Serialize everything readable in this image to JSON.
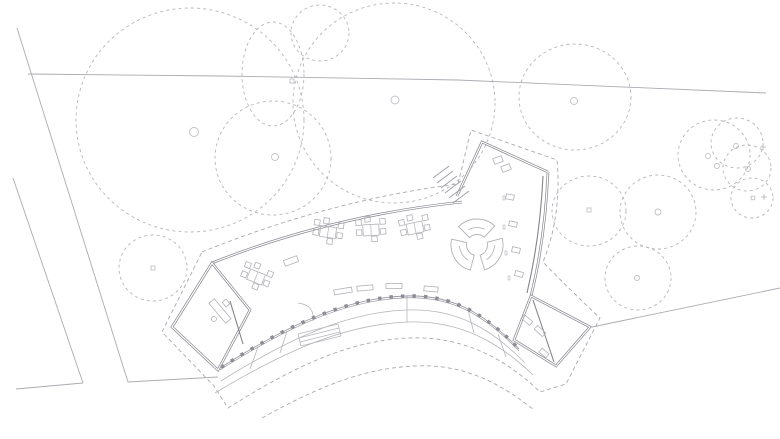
{
  "meta": {
    "title": "Architectural site plan — curved pavilion with terrace and trees",
    "canvas": {
      "w": 780,
      "h": 439,
      "bg": "#ffffff"
    }
  },
  "palette": {
    "tree": "#b6b6bc",
    "trunk": "#c2c2c8",
    "site_line": "#ababb1",
    "wall_dark": "#84848c",
    "wall_core": "#ffffff",
    "facade": "#9b9ba3",
    "tick": "#8d8d95",
    "terrace": "#b6b6bc",
    "roof_dash": "#aaaab0",
    "furniture": "#b2b2b8",
    "furniture_dark": "#9d9da5"
  },
  "drawing": {
    "trees": [
      {
        "name": "large-tree",
        "cx": 190,
        "cy": 120,
        "rx": 114,
        "ry": 112,
        "trunk": {
          "t": "circle",
          "x": 194,
          "y": 132,
          "s": 4.5
        }
      },
      {
        "name": "small-tree",
        "cx": 320,
        "cy": 33,
        "rx": 29,
        "ry": 28
      },
      {
        "name": "small-tree",
        "cx": 273,
        "cy": 74,
        "rx": 31,
        "ry": 52,
        "trunk": {
          "t": "square",
          "x": 292,
          "y": 81,
          "s": 4
        }
      },
      {
        "name": "medium-tree",
        "cx": 273,
        "cy": 158,
        "rx": 58,
        "ry": 57,
        "trunk": {
          "t": "circle",
          "x": 275,
          "y": 157,
          "s": 3.5
        }
      },
      {
        "name": "large-tree",
        "cx": 394,
        "cy": 103,
        "rx": 101,
        "ry": 100,
        "trunk": {
          "t": "circle",
          "x": 395,
          "y": 100,
          "s": 4
        }
      },
      {
        "name": "small-tree",
        "cx": 153,
        "cy": 268,
        "rx": 34,
        "ry": 33,
        "trunk": {
          "t": "square",
          "x": 153,
          "y": 268,
          "s": 4
        }
      },
      {
        "name": "medium-tree",
        "cx": 575,
        "cy": 97,
        "rx": 56,
        "ry": 53,
        "trunk": {
          "t": "circle",
          "x": 574,
          "y": 101,
          "s": 3.5
        }
      },
      {
        "name": "medium-tree",
        "cx": 589,
        "cy": 211,
        "rx": 37,
        "ry": 35,
        "trunk": {
          "t": "square",
          "x": 589,
          "y": 210,
          "s": 4
        }
      },
      {
        "name": "medium-tree",
        "cx": 658,
        "cy": 212,
        "rx": 38,
        "ry": 37,
        "trunk": {
          "t": "circle",
          "x": 658,
          "y": 212,
          "s": 3
        }
      },
      {
        "name": "medium-tree",
        "cx": 638,
        "cy": 278,
        "rx": 33,
        "ry": 32,
        "trunk": {
          "t": "circle",
          "x": 637,
          "y": 278,
          "s": 2.5
        }
      },
      {
        "name": "small-tree",
        "cx": 714,
        "cy": 155,
        "rx": 36,
        "ry": 35,
        "trunk": {
          "t": "circle",
          "x": 708,
          "y": 156,
          "s": 2.5
        }
      },
      {
        "name": "small-tree",
        "cx": 737,
        "cy": 143,
        "rx": 26,
        "ry": 25,
        "trunk": {
          "t": "circle",
          "x": 736,
          "y": 146,
          "s": 2.5
        }
      },
      {
        "name": "small-tree",
        "cx": 747,
        "cy": 168,
        "rx": 24,
        "ry": 23,
        "trunk": {
          "t": "circle",
          "x": 748,
          "y": 169,
          "s": 2.5
        }
      },
      {
        "name": "small-tree",
        "cx": 752,
        "cy": 198,
        "rx": 21,
        "ry": 20,
        "trunk": {
          "t": "square",
          "x": 753,
          "y": 198,
          "s": 3.5
        }
      }
    ],
    "extra_trunks": [
      {
        "t": "circle",
        "x": 717,
        "y": 166,
        "s": 2.5
      }
    ],
    "plus_markers": [
      [
        763,
        147
      ],
      [
        764,
        197
      ]
    ],
    "site_lines": [
      {
        "name": "site-boundary-line",
        "pts": [
          [
            17,
            28
          ],
          [
            128,
            382
          ]
        ]
      },
      {
        "name": "site-boundary-line",
        "pts": [
          [
            13,
            178
          ],
          [
            83,
            383
          ]
        ]
      },
      {
        "name": "site-boundary-line",
        "pts": [
          [
            16,
            389
          ],
          [
            83,
            383
          ]
        ]
      },
      {
        "name": "path-edge-line",
        "pts": [
          [
            128,
            382
          ],
          [
            218,
            377
          ]
        ]
      },
      {
        "name": "contour-line",
        "pts": [
          [
            28,
            74
          ],
          [
            220,
            76
          ],
          [
            458,
            80
          ],
          [
            766,
            93
          ]
        ]
      },
      {
        "name": "path-edge-line",
        "pts": [
          [
            592,
            327
          ],
          [
            780,
            288
          ]
        ]
      }
    ],
    "walls": [
      {
        "name": "north-wall",
        "d": "M 212 263 Q 330 216 462 202"
      },
      {
        "name": "northeast-wing-wall",
        "d": "M 457 196 L 482 142 L 548 172"
      },
      {
        "name": "east-wall",
        "d": "M 548 172 Q 545 240 531 296"
      },
      {
        "name": "east-wing-walls",
        "d": "M 531 296 L 590 327 L 556 366 L 514 340 Z"
      },
      {
        "name": "west-wing-walls",
        "d": "M 212 263 L 172 327 L 218 370 L 250 310 Z"
      }
    ],
    "thin_walls": [
      {
        "name": "partition-wall",
        "d": "M 230 301 L 243 344"
      },
      {
        "name": "partition-wall",
        "d": "M 533 300 L 554 362"
      },
      {
        "name": "inner-glazing-line",
        "d": "M 543 176 Q 540 238 527 293"
      }
    ],
    "roof_dash": [
      {
        "name": "roof-overhang-outline",
        "d": "M 202 252 Q 330 200 458 184 L 471 130 L 557 160 Q 562 215 543 262 Q 572 292 600 318 L 566 384 L 540 392 C 505 358 462 336 410 338 C 350 340 295 366 228 408 L 214 386 L 162 332 Z"
      },
      {
        "name": "terrace-edge-dashed",
        "d": "M 262 418 C 330 380 372 368 415 366 C 458 364 494 378 534 410"
      }
    ],
    "facade": {
      "d": "M 220 368 C 280 330 342 298 405 296 C 455 294 487 316 519 349",
      "tick_spacing": 11.5,
      "tick_size": 3.4
    },
    "terrace_arcs": [
      {
        "name": "terrace-arc",
        "d": "M 221 381 C 285 341 345 312 407 310 C 456 308 492 329 525 363"
      },
      {
        "name": "terrace-arc",
        "d": "M 215 393 C 283 352 345 324 408 322 C 460 320 500 343 533 375"
      }
    ],
    "dividers": [
      [
        258,
        347,
        250,
        369
      ],
      [
        287,
        331,
        280,
        353
      ],
      [
        407,
        296,
        407,
        322
      ],
      [
        468,
        310,
        474,
        333
      ],
      [
        498,
        334,
        506,
        357
      ]
    ],
    "terrace_steps": [
      [
        298,
        334,
        338,
        324
      ],
      [
        299,
        338,
        339,
        328
      ],
      [
        300,
        342,
        340,
        332
      ],
      [
        301,
        346,
        341,
        336
      ],
      [
        298,
        334,
        301,
        346
      ],
      [
        338,
        324,
        341,
        336
      ]
    ],
    "entry_stairs": [
      [
        449,
        166,
        433,
        178
      ],
      [
        453,
        171,
        437,
        183
      ],
      [
        457,
        176,
        441,
        188
      ],
      [
        461,
        181,
        445,
        193
      ],
      [
        465,
        186,
        449,
        198
      ],
      [
        469,
        191,
        453,
        203
      ]
    ],
    "door_swing": {
      "d": "M 298 303 Q 315 305 313 321"
    },
    "cluster_template": {
      "table": {
        "w": 16,
        "h": 11
      },
      "chair_size": 5.5,
      "chairs": [
        [
          -12,
          -8
        ],
        [
          -12,
          2
        ],
        [
          12,
          -8
        ],
        [
          12,
          2
        ],
        [
          -3,
          -11
        ],
        [
          3,
          9
        ]
      ]
    },
    "furniture_clusters": [
      {
        "cx": 256,
        "cy": 277,
        "rot": 22
      },
      {
        "cx": 328,
        "cy": 232,
        "rot": 8
      },
      {
        "cx": 371,
        "cy": 230,
        "rot": -3
      },
      {
        "cx": 415,
        "cy": 228,
        "rot": -12
      }
    ],
    "benches": [
      {
        "x": 343,
        "y": 291,
        "w": 18,
        "h": 5,
        "rot": -9
      },
      {
        "x": 365,
        "y": 288,
        "w": 16,
        "h": 5,
        "rot": -5
      },
      {
        "x": 394,
        "y": 286,
        "w": 16,
        "h": 5,
        "rot": 0
      },
      {
        "x": 431,
        "y": 289,
        "w": 14,
        "h": 5,
        "rot": 5
      },
      {
        "x": 291,
        "y": 261,
        "w": 14,
        "h": 6,
        "rot": -20
      },
      {
        "x": 527,
        "y": 320,
        "w": 11,
        "h": 5,
        "rot": 40
      },
      {
        "x": 540,
        "y": 331,
        "w": 11,
        "h": 5,
        "rot": 43
      },
      {
        "x": 498,
        "y": 160,
        "w": 9,
        "h": 6,
        "rot": -20
      },
      {
        "x": 506,
        "y": 168,
        "w": 9,
        "h": 6,
        "rot": -20
      },
      {
        "x": 544,
        "y": 353,
        "w": 9,
        "h": 5,
        "rot": 40
      }
    ],
    "shelves": [
      {
        "x": 510,
        "y": 197,
        "w": 8,
        "h": 5,
        "rot": 10
      },
      {
        "x": 513,
        "y": 224,
        "w": 8,
        "h": 5,
        "rot": 12
      },
      {
        "x": 516,
        "y": 250,
        "w": 8,
        "h": 5,
        "rot": 13
      },
      {
        "x": 519,
        "y": 274,
        "w": 8,
        "h": 5,
        "rot": 15
      }
    ],
    "tiny_marks": [
      {
        "x": 504,
        "y": 198
      },
      {
        "x": 504,
        "y": 227
      },
      {
        "x": 506,
        "y": 253
      },
      {
        "x": 509,
        "y": 278
      }
    ],
    "desk": {
      "x": 220,
      "y": 311,
      "w": 26,
      "h": 7,
      "rot": 50
    },
    "desk_chair": {
      "x": 226,
      "y": 303,
      "w": 6,
      "h": 5,
      "rot": 50
    },
    "desk_dot": {
      "x": 214,
      "y": 319,
      "r": 2.5
    },
    "pinwheel": {
      "cx": 477,
      "cy": 245,
      "r_outer": 26,
      "r_inner": 10.5,
      "r_detail": 17.5,
      "blades": 3,
      "span_deg": 88,
      "detail_span_deg": 56,
      "offset_deg": -15
    }
  }
}
